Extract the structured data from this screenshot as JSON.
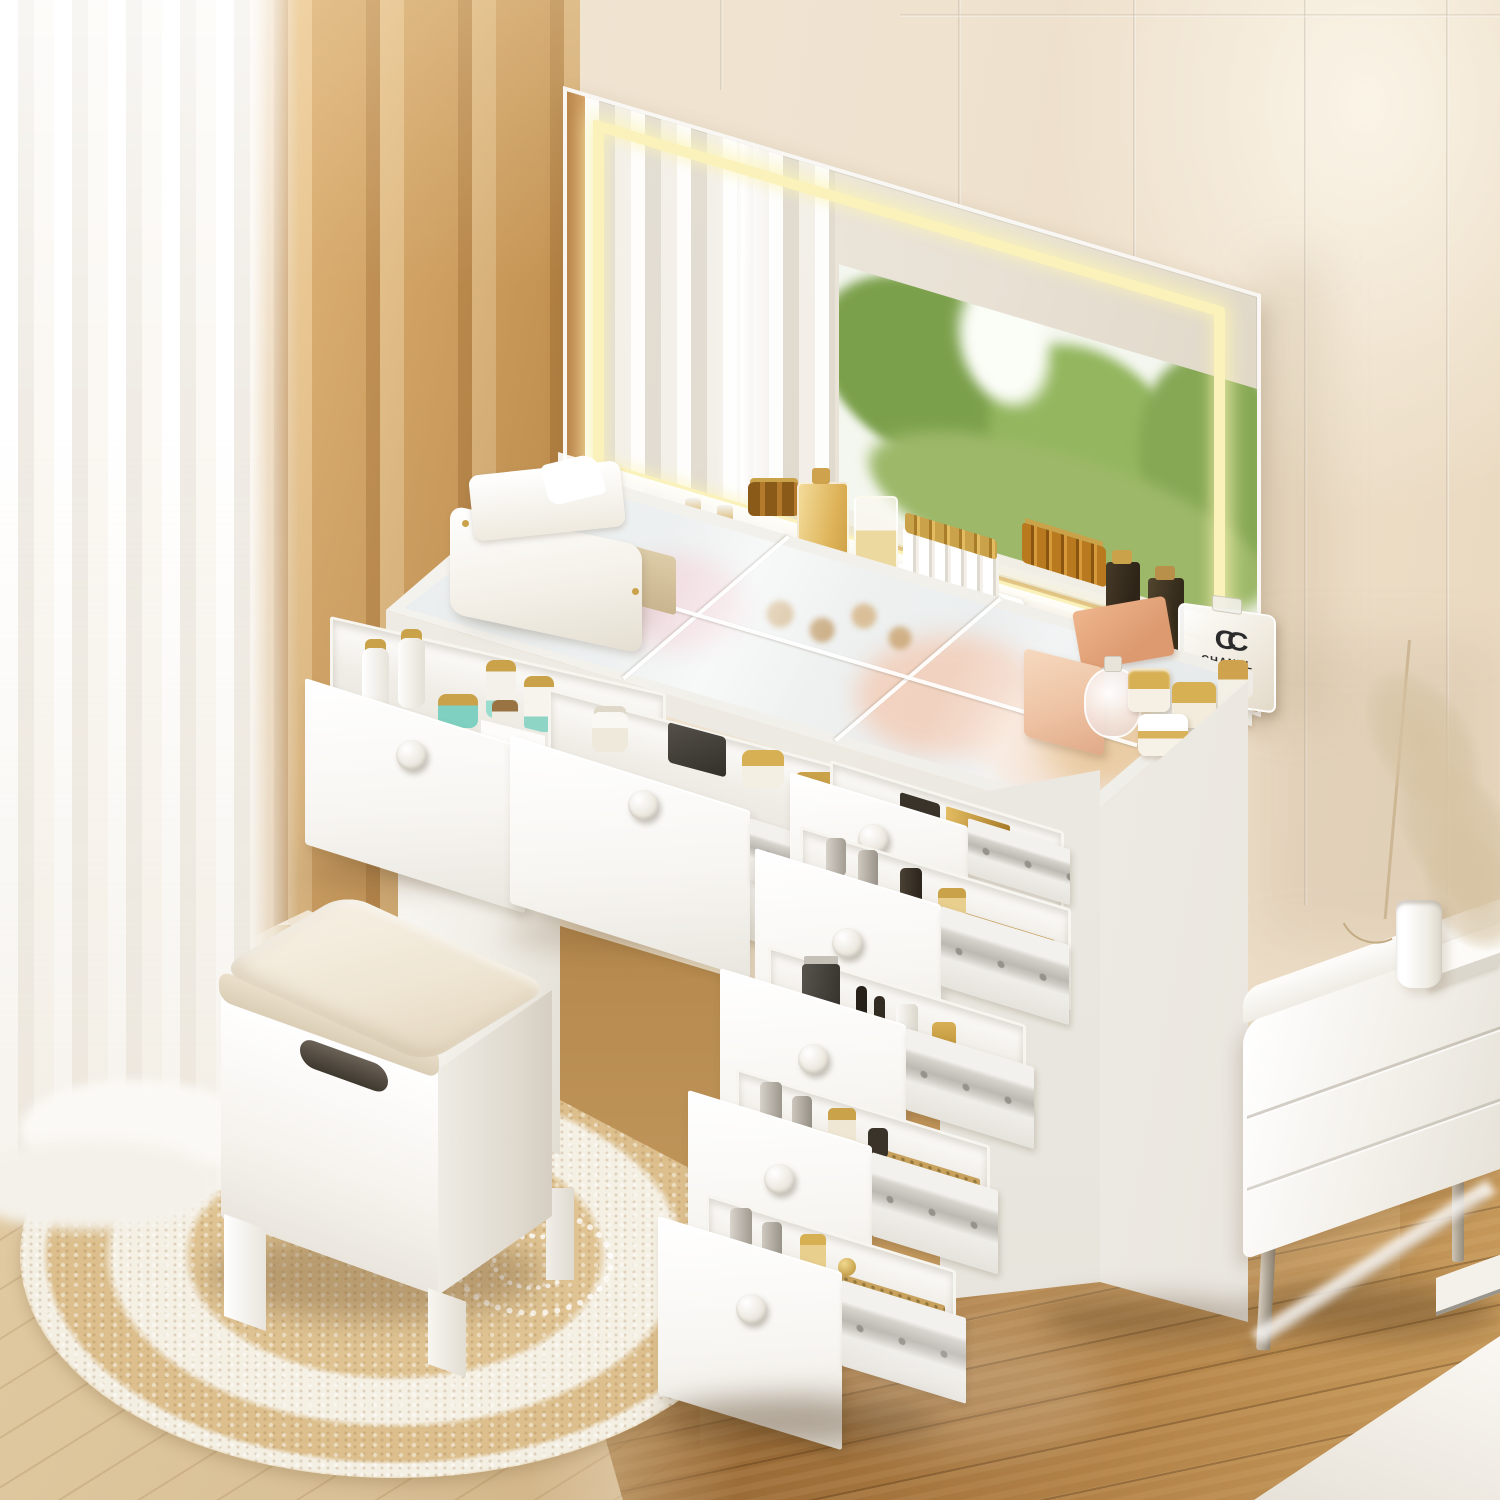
{
  "image": {
    "kind": "furniture product photo",
    "subject": "White makeup vanity desk with lighted LED mirror, tempered glass top, seven drawers pulled open showing cosmetics, and matching cushioned storage stool",
    "setting": "bright bedroom corner with layered curtains, round braided jute rug, wood floor, white nightstand and bed corner"
  },
  "palette": {
    "wall_cream": "#efe3d1",
    "curtain_tan": "#d9a763",
    "curtain_sheer": "#f7f4ee",
    "furniture_white": "#f7f5f1",
    "led_glow": "#faf2ba",
    "glass_tint": "#dfe7ea",
    "cushion_beige": "#f0e8d7",
    "rug_jute": "#dcc08e",
    "rug_white": "#f4efe3",
    "floor_light": "#dcc49c",
    "floor_dark": "#9a6c35",
    "gold_accent": "#cfa24e",
    "teal_jar": "#7fd0c0",
    "foliage_green": "#86a855",
    "pink_box": "#eec3a4"
  },
  "objects": {
    "mirror": {
      "type": "wide LED mirror",
      "led_band": "warm white inner light strip",
      "reflection": [
        "white sheer curtain folds",
        "window with green trees",
        "white window sill",
        "wood floor"
      ]
    },
    "vanity": {
      "top": "clear glass over storage compartments",
      "back_shelf_items": [
        "white spray bottles",
        "amber mini bottles",
        "gold perfume flacon",
        "lipstick display set",
        "dark perfume bottles",
        "white CHANEL perfume bottle"
      ],
      "glass_items": [
        "white leather tissue holder",
        "peach gift boxes",
        "gold-lid cream jars",
        "round perfume bottle"
      ],
      "drawers_total": 7,
      "drawers_open": 7,
      "knob_style": "round white wooden knob",
      "slides": "silver ball-bearing rails"
    },
    "drawer_contents": [
      "skincare bottles with gold caps",
      "teal cream jars",
      "silver cylinder bottles",
      "gold perfume bottles",
      "black makeup tubes",
      "gold mesh mat"
    ],
    "stool": {
      "type": "flip-top storage stool",
      "cushion": "beige linen",
      "body": "white wood with hand slot"
    },
    "rug": {
      "type": "round braided jute rug",
      "pattern": "natural jute with white concentric rings and dotted rosette"
    },
    "curtains": {
      "left": "white sheer",
      "inner": "caramel tan blackout"
    },
    "nightstand": {
      "color": "white",
      "legs": "slim metal",
      "top_items": [
        "white cylinder vase with dried pampas grass",
        "white book"
      ]
    },
    "bed": {
      "visible": "corner of white bedding",
      "position": "bottom right"
    },
    "floor": {
      "left": "light oak planks",
      "right": "warm brown glossy planks"
    },
    "wall": {
      "finish": "cream panel moulding with vertical grooves"
    }
  },
  "branding": {
    "perfume_logo": "CC",
    "perfume_label": "CHANEL"
  }
}
